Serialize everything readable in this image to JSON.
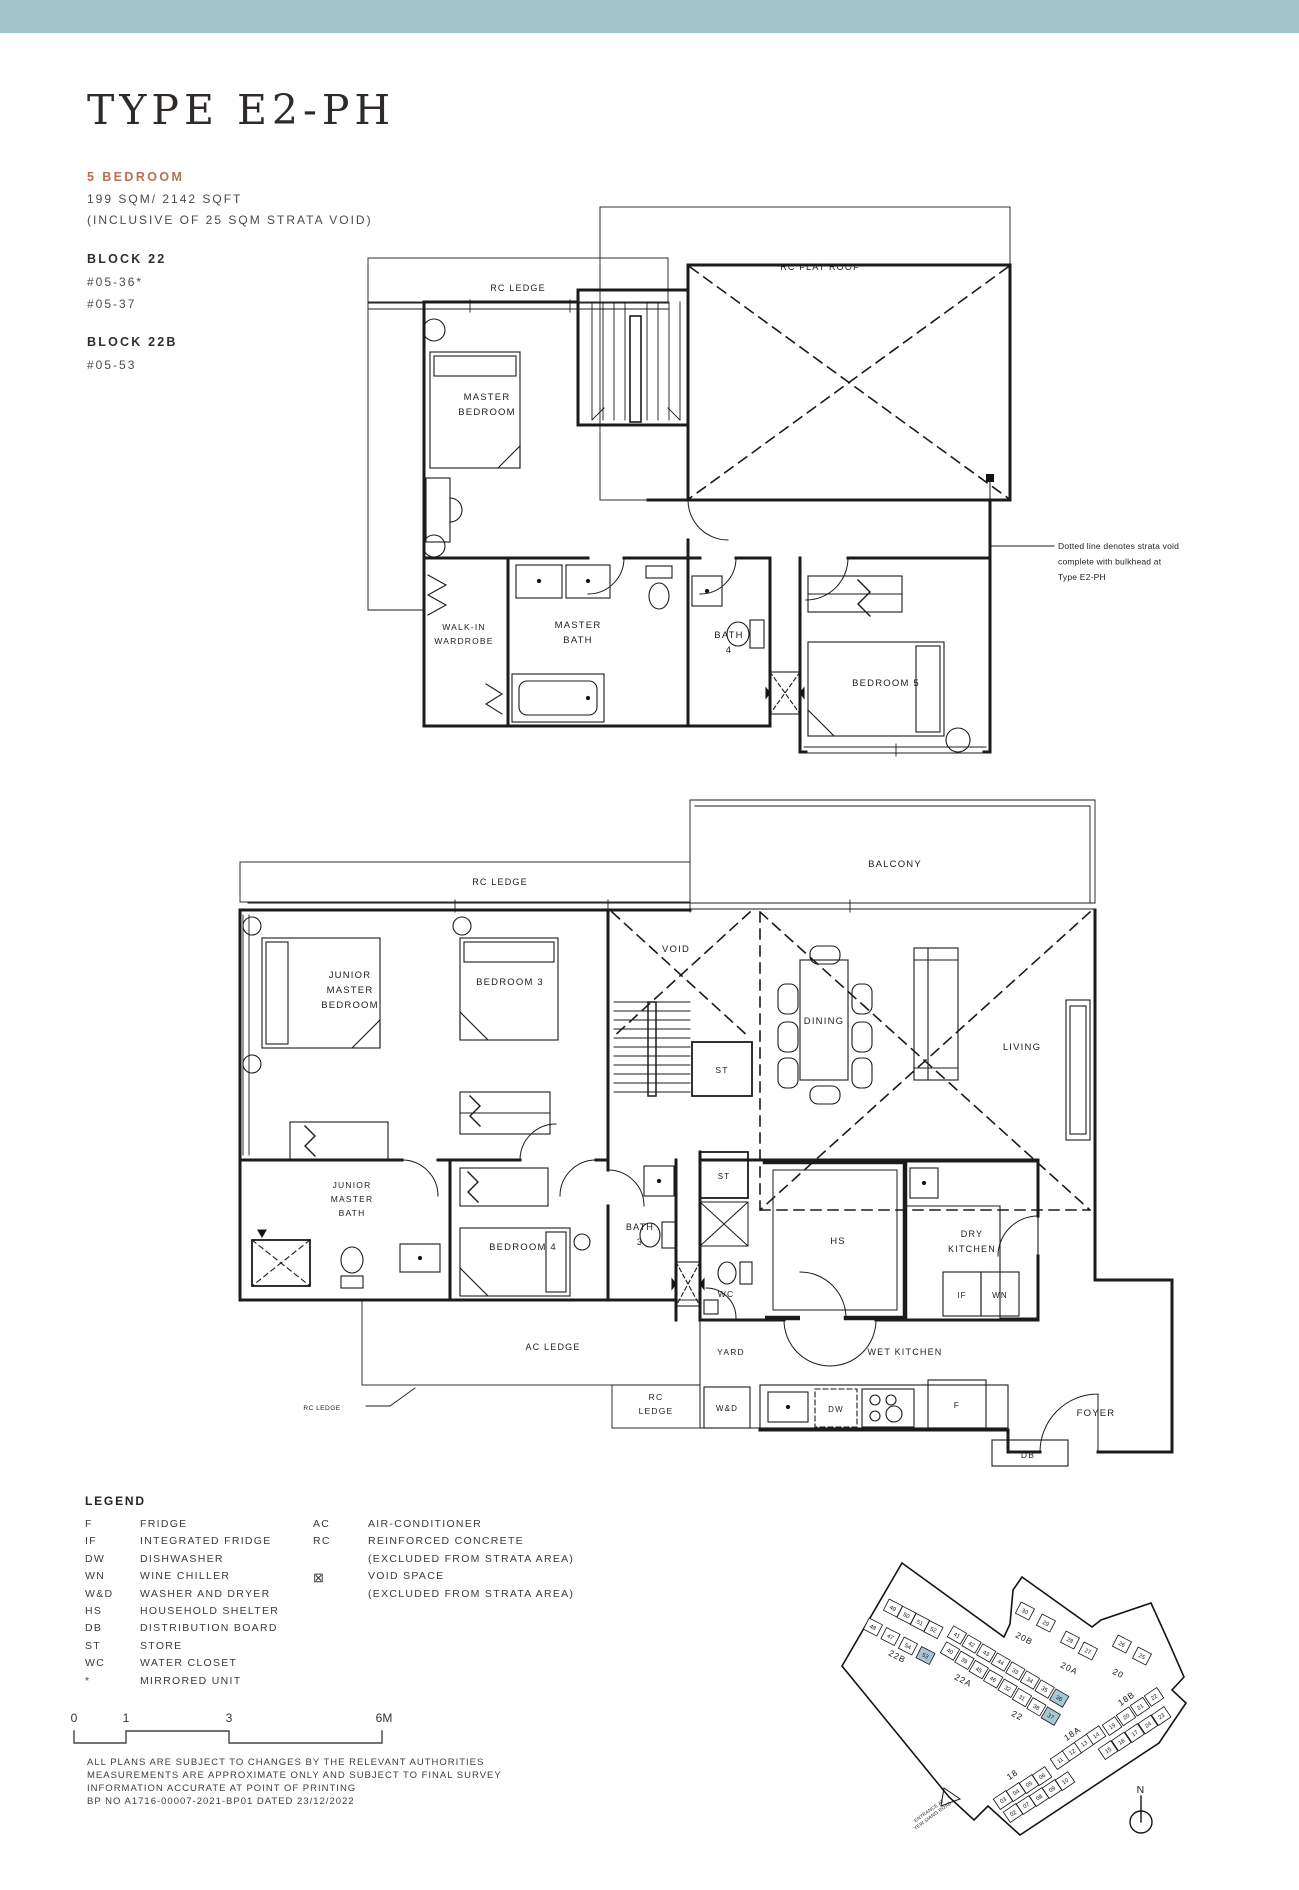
{
  "page": {
    "top_bar_color": "#a1c3ca",
    "background": "#ffffff",
    "accent_color": "#b87053"
  },
  "header": {
    "title": "TYPE E2-PH",
    "bedroom_type": "5 BEDROOM",
    "area": "199 SQM/ 2142 SQFT",
    "area_note": "(INCLUSIVE OF 25 SQM STRATA VOID)",
    "block1_name": "BLOCK 22",
    "block1_unit1": "#05-36*",
    "block1_unit2": "#05-37",
    "block2_name": "BLOCK 22B",
    "block2_unit1": "#05-53"
  },
  "plan_labels": [
    {
      "id": "upper-rc-ledge-label",
      "lines": [
        "RC LEDGE"
      ],
      "x": 518,
      "y": 291,
      "s": 9
    },
    {
      "id": "upper-rc-flat-roof-label",
      "lines": [
        "RC FLAT ROOF"
      ],
      "x": 820,
      "y": 270,
      "s": 9
    },
    {
      "id": "master-bedroom-label",
      "lines": [
        "MASTER",
        "BEDROOM"
      ],
      "x": 487,
      "y": 400,
      "s": 9.5,
      "lh": 15
    },
    {
      "id": "walk-in-wardrobe-label",
      "lines": [
        "WALK-IN",
        "WARDROBE"
      ],
      "x": 464,
      "y": 630,
      "s": 8.5,
      "lh": 14
    },
    {
      "id": "master-bath-label",
      "lines": [
        "MASTER",
        "BATH"
      ],
      "x": 578,
      "y": 628,
      "s": 9.5,
      "lh": 15
    },
    {
      "id": "bath-4-label",
      "lines": [
        "BATH",
        "4"
      ],
      "x": 729,
      "y": 638,
      "s": 9.5,
      "lh": 15
    },
    {
      "id": "bedroom-5-label",
      "lines": [
        "BEDROOM 5"
      ],
      "x": 886,
      "y": 686,
      "s": 9.5
    },
    {
      "id": "strata-void-note",
      "lines": [
        "Dotted line denotes strata void",
        "complete with bulkhead at",
        "Type E2-PH"
      ],
      "x": 1058,
      "y": 549,
      "s": 8.5,
      "lh": 15.5,
      "a": "start",
      "ls": "0.2px"
    },
    {
      "id": "lower-rc-ledge-label",
      "lines": [
        "RC LEDGE"
      ],
      "x": 500,
      "y": 885,
      "s": 9
    },
    {
      "id": "balcony-label",
      "lines": [
        "BALCONY"
      ],
      "x": 895,
      "y": 867,
      "s": 9.5
    },
    {
      "id": "junior-master-bedroom-label",
      "lines": [
        "JUNIOR",
        "MASTER",
        "BEDROOM"
      ],
      "x": 350,
      "y": 978,
      "s": 9.5,
      "lh": 15
    },
    {
      "id": "bedroom-3-label",
      "lines": [
        "BEDROOM 3"
      ],
      "x": 510,
      "y": 985,
      "s": 9.5
    },
    {
      "id": "void-label",
      "lines": [
        "VOID"
      ],
      "x": 676,
      "y": 952,
      "s": 9.5
    },
    {
      "id": "stair-store-label",
      "lines": [
        "ST"
      ],
      "x": 722,
      "y": 1073,
      "s": 8.5
    },
    {
      "id": "dining-label",
      "lines": [
        "DINING"
      ],
      "x": 824,
      "y": 1024,
      "s": 9.5
    },
    {
      "id": "living-label",
      "lines": [
        "LIVING"
      ],
      "x": 1022,
      "y": 1050,
      "s": 9.5
    },
    {
      "id": "junior-master-bath-label",
      "lines": [
        "JUNIOR",
        "MASTER",
        "BATH"
      ],
      "x": 352,
      "y": 1188,
      "s": 8.5,
      "lh": 14
    },
    {
      "id": "bedroom-4-label",
      "lines": [
        "BEDROOM 4"
      ],
      "x": 523,
      "y": 1250,
      "s": 9.5
    },
    {
      "id": "bath-3-label",
      "lines": [
        "BATH",
        "3"
      ],
      "x": 640,
      "y": 1230,
      "s": 9,
      "lh": 15
    },
    {
      "id": "store-2-label",
      "lines": [
        "ST"
      ],
      "x": 724,
      "y": 1179,
      "s": 8
    },
    {
      "id": "wc-label",
      "lines": [
        "WC"
      ],
      "x": 726,
      "y": 1297,
      "s": 8.5
    },
    {
      "id": "hs-label",
      "lines": [
        "HS"
      ],
      "x": 838,
      "y": 1244,
      "s": 9.5
    },
    {
      "id": "dry-kitchen-label",
      "lines": [
        "DRY",
        "KITCHEN"
      ],
      "x": 972,
      "y": 1237,
      "s": 9,
      "lh": 15
    },
    {
      "id": "if-label",
      "lines": [
        "IF"
      ],
      "x": 962,
      "y": 1298,
      "s": 8
    },
    {
      "id": "wn-label",
      "lines": [
        "WN"
      ],
      "x": 1000,
      "y": 1298,
      "s": 8
    },
    {
      "id": "ac-ledge-label",
      "lines": [
        "AC LEDGE"
      ],
      "x": 553,
      "y": 1350,
      "s": 9
    },
    {
      "id": "yard-label",
      "lines": [
        "YARD"
      ],
      "x": 731,
      "y": 1355,
      "s": 8.5
    },
    {
      "id": "wet-kitchen-label",
      "lines": [
        "WET KITCHEN"
      ],
      "x": 905,
      "y": 1355,
      "s": 9
    },
    {
      "id": "rc-ledge-2-label",
      "lines": [
        "RC",
        "LEDGE"
      ],
      "x": 656,
      "y": 1400,
      "s": 8.5,
      "lh": 14
    },
    {
      "id": "wd-label",
      "lines": [
        "W&D"
      ],
      "x": 727,
      "y": 1411,
      "s": 8
    },
    {
      "id": "dw-label",
      "lines": [
        "DW"
      ],
      "x": 836,
      "y": 1412,
      "s": 8
    },
    {
      "id": "fridge-label",
      "lines": [
        "F"
      ],
      "x": 957,
      "y": 1408,
      "s": 8.5
    },
    {
      "id": "foyer-label",
      "lines": [
        "FOYER"
      ],
      "x": 1096,
      "y": 1416,
      "s": 9.5
    },
    {
      "id": "db-label",
      "lines": [
        "DB"
      ],
      "x": 1028,
      "y": 1458,
      "s": 8.5
    },
    {
      "id": "rc-ledge-callout",
      "lines": [
        "RC LEDGE"
      ],
      "x": 322,
      "y": 1410,
      "s": 6.5,
      "ls": "0.5px"
    },
    {
      "id": "north-label",
      "lines": [
        "N"
      ],
      "x": 1141,
      "y": 1793,
      "s": 10.5
    },
    {
      "id": "entrance-label",
      "lines": [
        "ENTRANCE AT",
        "YEW SIANG ROAD"
      ],
      "x": 930,
      "y": 1812,
      "s": 4.8,
      "lh": 6,
      "rot": -36,
      "ls": "0.2px"
    }
  ],
  "site_plan": {
    "highlight_color": "#a7c8d2",
    "block_labels": [
      {
        "t": "22B",
        "x": 896,
        "y": 1659,
        "r": 27
      },
      {
        "t": "22A",
        "x": 962,
        "y": 1683,
        "r": 27
      },
      {
        "t": "22",
        "x": 1016,
        "y": 1718,
        "r": 27
      },
      {
        "t": "20B",
        "x": 1023,
        "y": 1641,
        "r": 27
      },
      {
        "t": "20A",
        "x": 1068,
        "y": 1671,
        "r": 27
      },
      {
        "t": "20",
        "x": 1117,
        "y": 1676,
        "r": 27
      },
      {
        "t": "18B",
        "x": 1128,
        "y": 1701,
        "r": -34
      },
      {
        "t": "18A",
        "x": 1074,
        "y": 1736,
        "r": -34
      },
      {
        "t": "18",
        "x": 1014,
        "y": 1777,
        "r": -34
      }
    ],
    "rows": [
      {
        "units": [
          "49",
          "50",
          "51",
          "52"
        ],
        "x": 893,
        "y": 1608,
        "dx": 13.5,
        "dy": 7.2,
        "ang": 27,
        "hl": []
      },
      {
        "units": [
          "48",
          "47",
          "54",
          "53"
        ],
        "x": 873,
        "y": 1627,
        "dx": 17.5,
        "dy": 9.5,
        "ang": 27,
        "hl": [
          "53"
        ]
      },
      {
        "units": [
          "41",
          "42",
          "43",
          "44",
          "33",
          "34",
          "35",
          "36"
        ],
        "x": 957,
        "y": 1635,
        "dx": 14.6,
        "dy": 9.0,
        "ang": 30,
        "hl": [
          "36"
        ]
      },
      {
        "units": [
          "40",
          "39",
          "45",
          "46",
          "32",
          "31",
          "38",
          "37"
        ],
        "x": 950,
        "y": 1651,
        "dx": 14.4,
        "dy": 9.3,
        "ang": 30,
        "hl": [
          "37"
        ]
      },
      {
        "units": [
          "30",
          "29"
        ],
        "x": 1025,
        "y": 1611,
        "dx": 21,
        "dy": 12,
        "ang": 27,
        "hl": []
      },
      {
        "units": [
          "28",
          "27"
        ],
        "x": 1070,
        "y": 1640,
        "dx": 18,
        "dy": 11,
        "ang": 27,
        "hl": []
      },
      {
        "units": [
          "26",
          "25"
        ],
        "x": 1122,
        "y": 1644,
        "dx": 20,
        "dy": 12,
        "ang": 27,
        "hl": []
      },
      {
        "units": [
          "19",
          "20",
          "21",
          "22"
        ],
        "x": 1112,
        "y": 1726,
        "dx": 14,
        "dy": -9.7,
        "ang": -34,
        "hl": []
      },
      {
        "units": [
          "15",
          "16",
          "17",
          "24",
          "23"
        ],
        "x": 1108,
        "y": 1750,
        "dx": 13.3,
        "dy": -8.5,
        "ang": -34,
        "hl": []
      },
      {
        "units": [
          "11",
          "12",
          "13",
          "14"
        ],
        "x": 1060,
        "y": 1760,
        "dx": 12,
        "dy": -8.3,
        "ang": -34,
        "hl": []
      },
      {
        "units": [
          "03",
          "04",
          "05",
          "06"
        ],
        "x": 1003,
        "y": 1800,
        "dx": 13,
        "dy": -8,
        "ang": -34,
        "hl": []
      },
      {
        "units": [
          "02",
          "07",
          "08",
          "09",
          "10"
        ],
        "x": 1013,
        "y": 1813,
        "dx": 13,
        "dy": -8,
        "ang": -34,
        "hl": []
      }
    ]
  },
  "legend": {
    "title": "LEGEND",
    "left": [
      [
        "F",
        "FRIDGE"
      ],
      [
        "IF",
        "INTEGRATED FRIDGE"
      ],
      [
        "DW",
        "DISHWASHER"
      ],
      [
        "WN",
        "WINE CHILLER"
      ],
      [
        "W&D",
        "WASHER AND DRYER"
      ],
      [
        "HS",
        "HOUSEHOLD SHELTER"
      ],
      [
        "DB",
        "DISTRIBUTION BOARD"
      ],
      [
        "ST",
        "STORE"
      ],
      [
        "WC",
        "WATER CLOSET"
      ],
      [
        "*",
        "MIRRORED UNIT"
      ]
    ],
    "right": [
      [
        "AC",
        "AIR-CONDITIONER"
      ],
      [
        "RC",
        "REINFORCED CONCRETE"
      ],
      [
        "",
        "(EXCLUDED FROM STRATA AREA)"
      ],
      [
        "⊠",
        "VOID SPACE"
      ],
      [
        "",
        "(EXCLUDED FROM STRATA AREA)"
      ]
    ]
  },
  "scale_bar": {
    "ticks": [
      {
        "t": "0",
        "x": 74
      },
      {
        "t": "1",
        "x": 126
      },
      {
        "t": "3",
        "x": 229
      },
      {
        "t": "6M",
        "x": 384
      }
    ]
  },
  "disclaimer": [
    "ALL PLANS ARE SUBJECT TO CHANGES BY THE RELEVANT AUTHORITIES",
    "MEASUREMENTS ARE APPROXIMATE ONLY AND SUBJECT TO FINAL SURVEY",
    "INFORMATION ACCURATE AT POINT OF PRINTING",
    "BP NO   A1716-00007-2021-BP01 DATED 23/12/2022"
  ]
}
